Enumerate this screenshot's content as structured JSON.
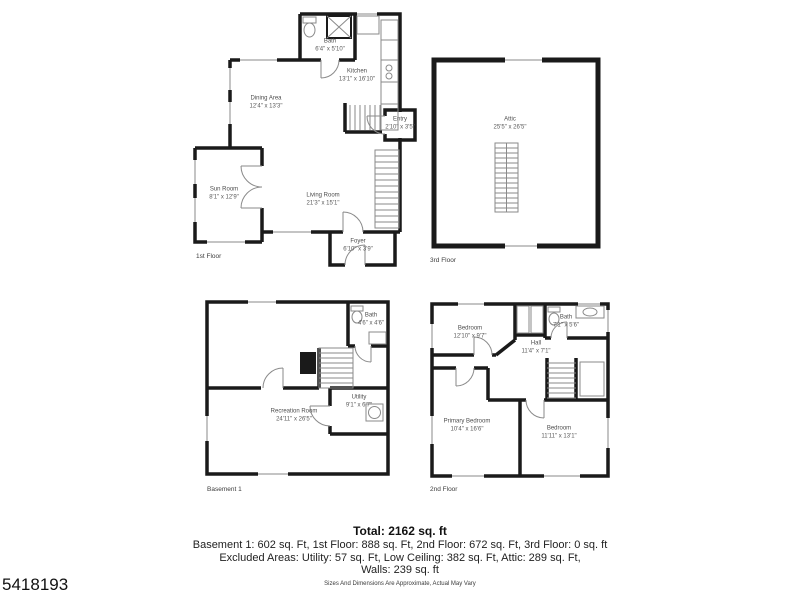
{
  "listing_id": "5418193",
  "plans": {
    "first_floor": {
      "floor_label": "1st Floor",
      "rooms": {
        "bath": {
          "name": "Bath",
          "dims": "6'4\" x 5'10\""
        },
        "kitchen": {
          "name": "Kitchen",
          "dims": "13'1\" x 16'10\""
        },
        "dining": {
          "name": "Dining Area",
          "dims": "12'4\" x 13'3\""
        },
        "entry": {
          "name": "Entry",
          "dims": "2'10\" x 3'5\""
        },
        "sun_room": {
          "name": "Sun Room",
          "dims": "8'1\" x 12'9\""
        },
        "living": {
          "name": "Living Room",
          "dims": "21'3\" x 15'1\""
        },
        "foyer": {
          "name": "Foyer",
          "dims": "6'10\" x 3'9\""
        }
      }
    },
    "third_floor": {
      "floor_label": "3rd Floor",
      "rooms": {
        "attic": {
          "name": "Attic",
          "dims": "25'5\" x 26'5\""
        }
      }
    },
    "basement": {
      "floor_label": "Basement 1",
      "rooms": {
        "bath": {
          "name": "Bath",
          "dims": "4'6\" x 4'6\""
        },
        "recreation": {
          "name": "Recreation Room",
          "dims": "24'11\" x 26'5\""
        },
        "utility": {
          "name": "Utility",
          "dims": "9'1\" x 6'7\""
        }
      }
    },
    "second_floor": {
      "floor_label": "2nd Floor",
      "rooms": {
        "bedroom1": {
          "name": "Bedroom",
          "dims": "12'10\" x 9'7\""
        },
        "bath": {
          "name": "Bath",
          "dims": "7'1\" x 5'6\""
        },
        "hall": {
          "name": "Hall",
          "dims": "11'4\" x 7'1\""
        },
        "primary": {
          "name": "Primary Bedroom",
          "dims": "10'4\" x 16'6\""
        },
        "bedroom2": {
          "name": "Bedroom",
          "dims": "11'11\" x 13'1\""
        }
      }
    }
  },
  "summary": {
    "total": "Total: 2162 sq. ft",
    "floor_areas": "Basement 1: 602 sq. Ft, 1st Floor: 888 sq. Ft, 2nd Floor: 672 sq. Ft, 3rd Floor: 0 sq. ft",
    "excluded_areas": "Excluded Areas: Utility: 57 sq. Ft, Low Ceiling: 382 sq. Ft, Attic: 289 sq. Ft,",
    "walls": "Walls: 239 sq. ft",
    "disclaimer": "Sizes And Dimensions Are Approximate, Actual May Vary"
  },
  "colors": {
    "wall": "#1a1a1a",
    "detail": "#8a8a8a",
    "label_text": "#4d4d4d",
    "background": "#ffffff"
  }
}
